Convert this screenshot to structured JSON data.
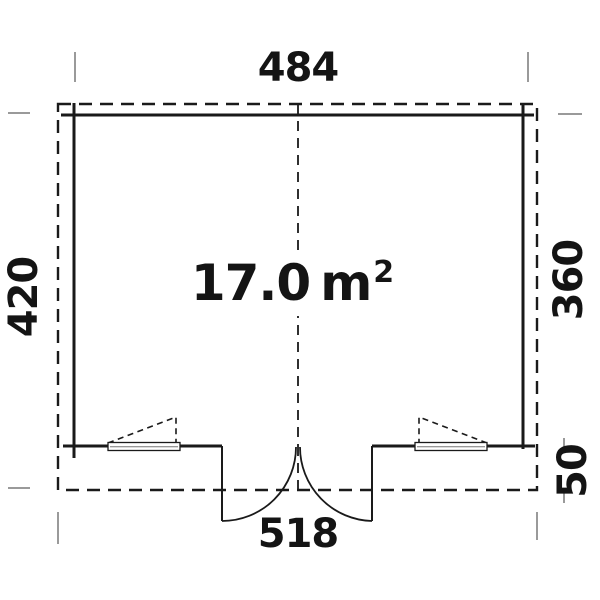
{
  "diagram": {
    "type": "floor-plan",
    "area": {
      "value": "17.0",
      "unit": "m",
      "exponent": "2"
    },
    "dimensions": {
      "top_width": "484",
      "bottom_width": "518",
      "left_height": "420",
      "right_height": "360",
      "right_porch_depth": "50"
    },
    "colors": {
      "line": "#1a1a1a",
      "tick": "#9a9a9a",
      "background": "#ffffff",
      "text": "#141414"
    }
  }
}
